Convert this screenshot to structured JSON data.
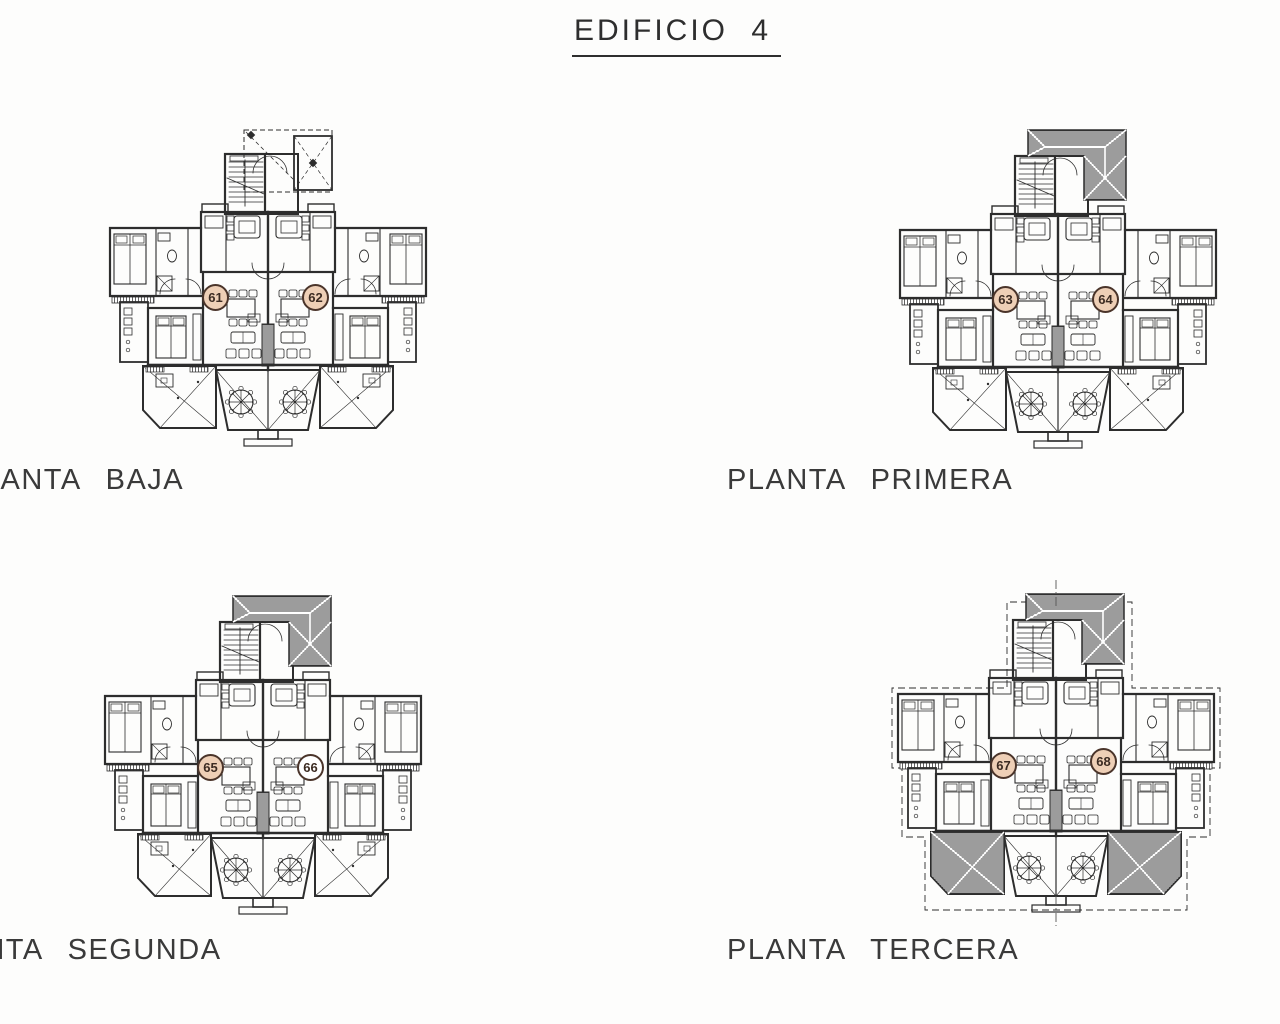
{
  "title": "EDIFICIO 4",
  "colors": {
    "ink": "#2d2d2d",
    "badge_fill": "#eecfb6",
    "badge_empty_fill": "#ffffff",
    "badge_stroke": "#4a342a"
  },
  "plans": [
    {
      "name": "planta-baja",
      "label": "PLANTA BAJA",
      "roof_style": "dashed-outline-with-entry-porch",
      "units": [
        {
          "number": "61",
          "highlighted": true
        },
        {
          "number": "62",
          "highlighted": true
        }
      ]
    },
    {
      "name": "planta-primera",
      "label": "PLANTA PRIMERA",
      "roof_style": "hatched-hip-roof",
      "units": [
        {
          "number": "63",
          "highlighted": true
        },
        {
          "number": "64",
          "highlighted": true
        }
      ]
    },
    {
      "name": "planta-segunda",
      "label": "PLANTA SEGUNDA",
      "roof_style": "hatched-hip-roof",
      "units": [
        {
          "number": "65",
          "highlighted": true
        },
        {
          "number": "66",
          "highlighted": false
        }
      ]
    },
    {
      "name": "planta-tercera",
      "label": "PLANTA TERCERA",
      "roof_style": "hatched-hip-roof",
      "annotations": [
        "dashed-roof-overhang",
        "hatched-terrace-pergolas",
        "center-axis-line"
      ],
      "units": [
        {
          "number": "67",
          "highlighted": true
        },
        {
          "number": "68",
          "highlighted": true
        }
      ]
    }
  ]
}
